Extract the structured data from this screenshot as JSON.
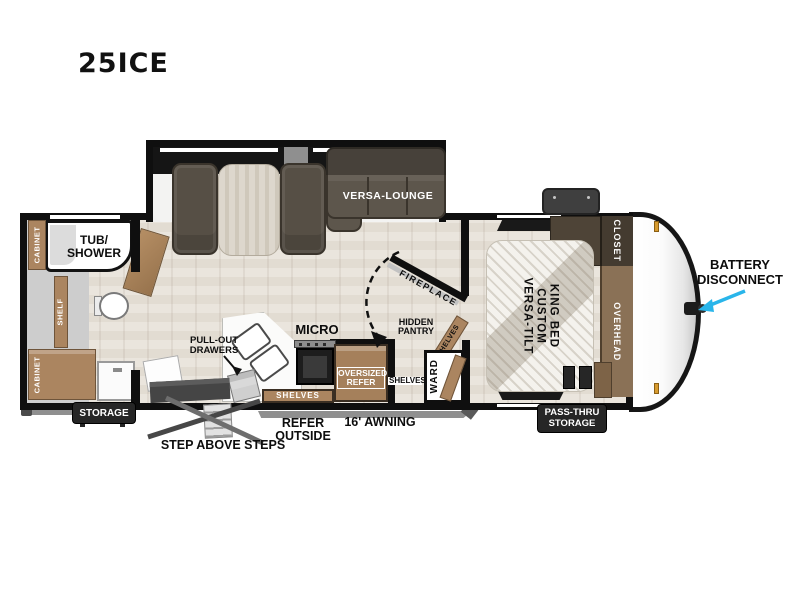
{
  "title": "25ICE",
  "bathroom": {
    "cabinet_upper": "CABINET",
    "tub_line1": "TUB/",
    "tub_line2": "SHOWER",
    "shelf": "SHELF",
    "cabinet_lower": "CABINET"
  },
  "living": {
    "lounge_label": "VERSA-LOUNGE"
  },
  "kitchen": {
    "pullout_line1": "PULL-OUT",
    "pullout_line2": "DRAWERS",
    "micro_label": "MICRO",
    "shelves_label": "SHELVES",
    "refer_line1": "OVERSIZED",
    "refer_line2": "REFER",
    "shelves_small_label": "SHELVES"
  },
  "pantry": {
    "fireplace_label": "FIREPLACE",
    "hidden_line1": "HIDDEN",
    "hidden_line2": "PANTRY",
    "shelves_diag_label": "SHELVES",
    "ward_label": "WARD"
  },
  "bedroom": {
    "bed_line1": "VERSA-TILT",
    "bed_line2": "CUSTOM",
    "bed_line3": "KING BED",
    "closet_label": "CLOSET",
    "overhead_label": "OVERHEAD"
  },
  "exterior": {
    "storage_label": "STORAGE",
    "passthru_line1": "PASS-THRU",
    "passthru_line2": "STORAGE",
    "awning_label": "16' AWNING",
    "refer_outside_line1": "REFER",
    "refer_outside_line2": "OUTSIDE",
    "steps_label": "STEP ABOVE STEPS",
    "battery_line1": "BATTERY",
    "battery_line2": "DISCONNECT"
  },
  "colors": {
    "arrow_accent": "#29b5ea",
    "wall": "#0f0f0f",
    "cabinet_tan": "#ab8560",
    "cabinet_dark": "#4a4137",
    "sofa": "#5d564c",
    "badge_bg": "#262626"
  }
}
